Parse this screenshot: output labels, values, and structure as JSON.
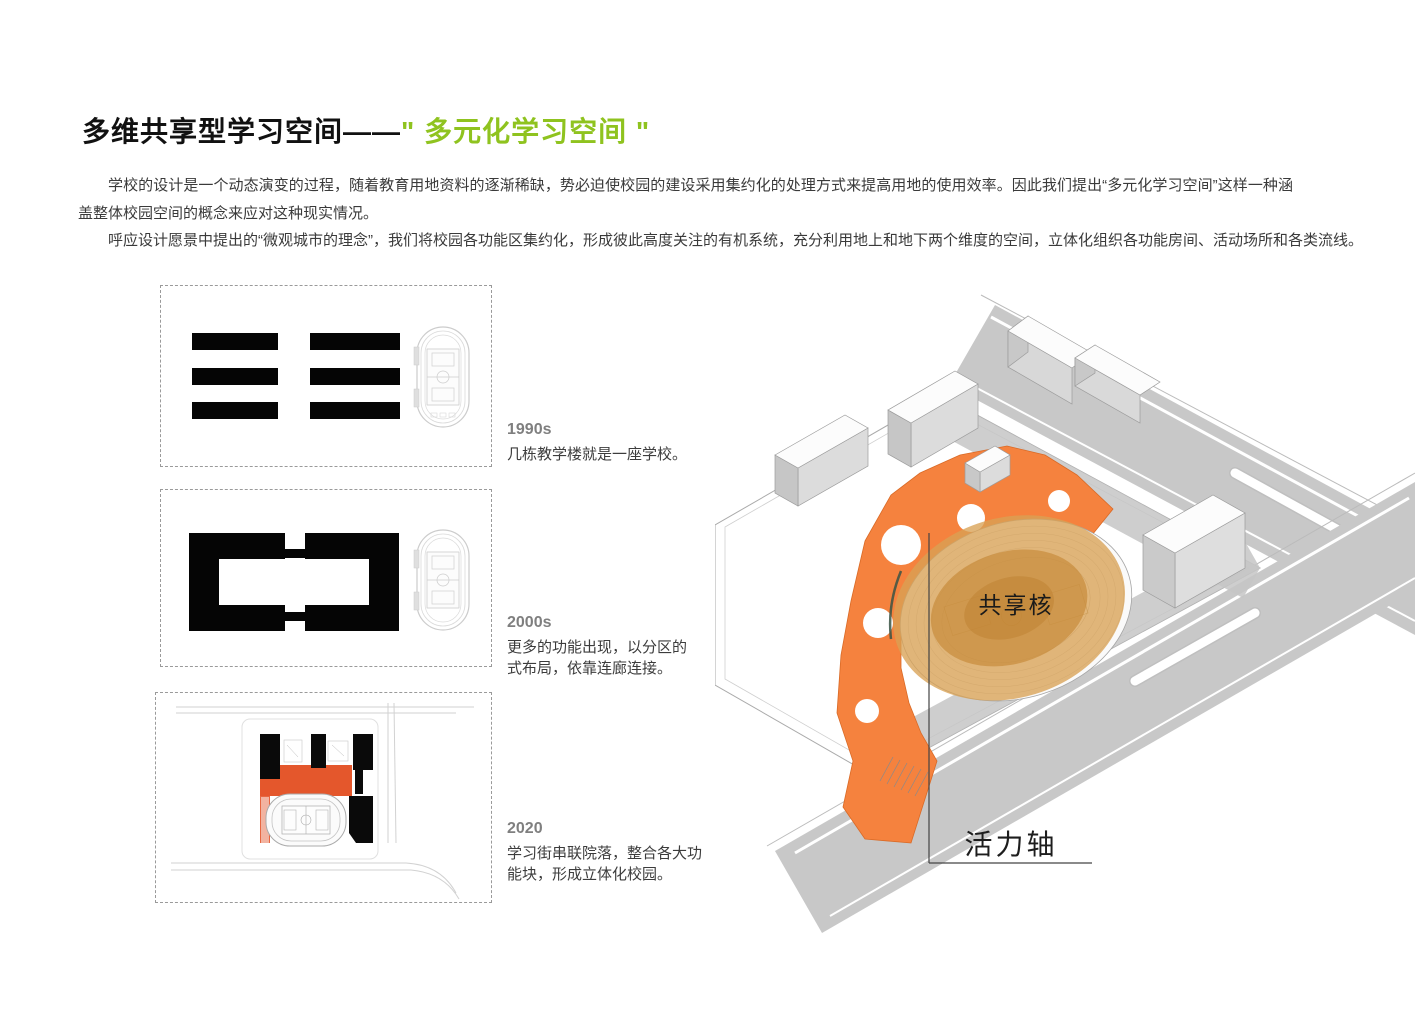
{
  "header": {
    "title_black": "多维共享型学习空间——",
    "title_green": "\" 多元化学习空间 \"",
    "green_hex": "#8FC31F"
  },
  "intro": {
    "paragraph1": "学校的设计是一个动态演变的过程，随着教育用地资料的逐渐稀缺，势必迫使校园的建设采用集约化的处理方式来提高用地的使用效率。因此我们提出“多元化学习空间”这样一种涵盖整体校园空间的概念来应对这种现实情况。",
    "paragraph2": "呼应设计愿景中提出的“微观城市的理念”，我们将校园各功能区集约化，形成彼此高度关注的有机系统，充分利用地上和地下两个维度的空间，立体化组织各功能房间、活动场所和各类流线。"
  },
  "timeline": [
    {
      "year": "1990s",
      "description": "几栋教学楼就是一座学校。"
    },
    {
      "year": "2000s",
      "description": "更多的功能出现，以分区的式布局，依靠连廊连接。"
    },
    {
      "year": "2020",
      "description": "学习街串联院落，整合各大功能块，形成立体化校园。"
    }
  ],
  "site_plan": {
    "core_label": "共享核",
    "axis_label": "活力轴",
    "colors": {
      "plaza_orange": "#F5823E",
      "mini_plaza_orange": "#E4572C",
      "core_amber": "#D9A155",
      "road_gray": "#C8C8C8",
      "year_gray": "#7F7F7F"
    }
  }
}
